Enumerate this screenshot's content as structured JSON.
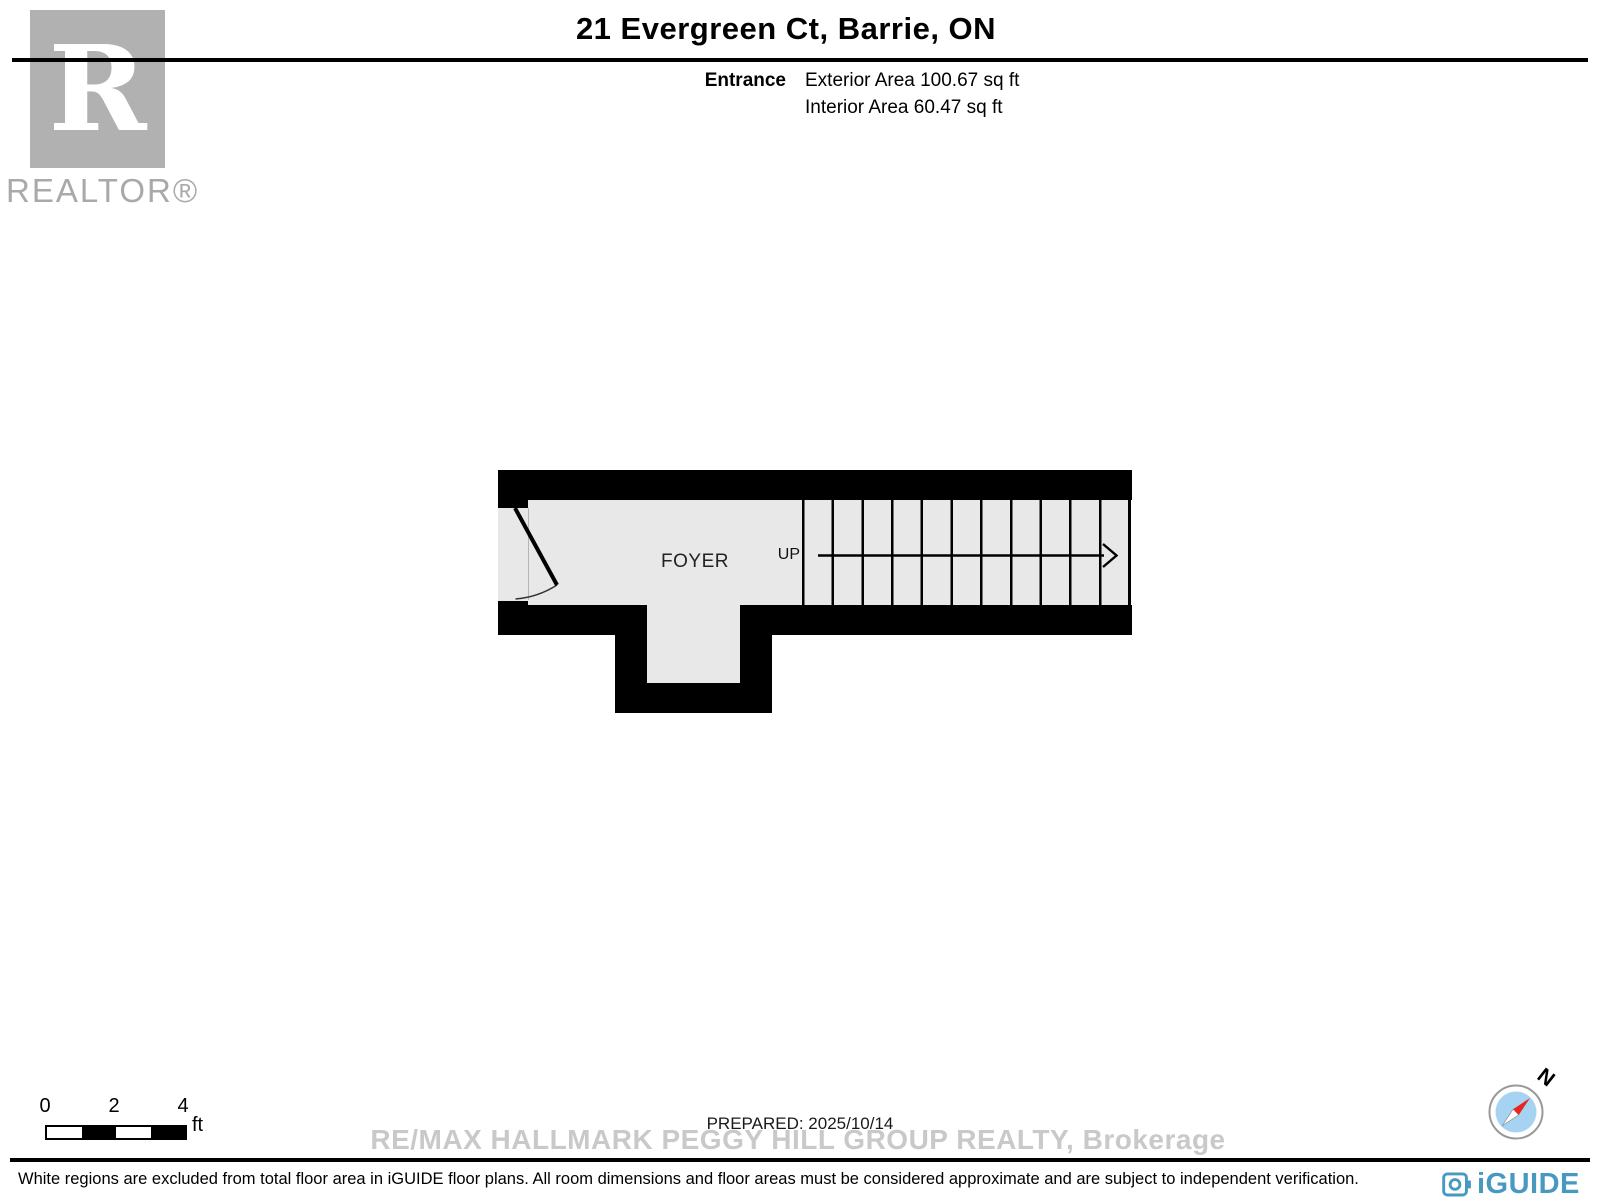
{
  "header": {
    "title": "21 Evergreen Ct, Barrie, ON",
    "floor_name": "Entrance",
    "exterior_area": "Exterior Area 100.67 sq ft",
    "interior_area": "Interior Area 60.47 sq ft"
  },
  "branding": {
    "realtor_logo_letter": "R",
    "realtor_wordmark": "REALTOR®",
    "iguide_wordmark": "iGUIDE",
    "iguide_color": "#4899c2",
    "realtor_gray": "#b1b1b1"
  },
  "floorplan": {
    "room_label": "FOYER",
    "stair_direction_label": "UP",
    "stair_tread_count": 11,
    "colors": {
      "floor": "#e8e8e8",
      "wall": "#000000"
    }
  },
  "scale_bar": {
    "labels": [
      "0",
      "2",
      "4"
    ],
    "unit": "ft"
  },
  "compass": {
    "north_label": "N",
    "colors": {
      "inner": "#a7d3f2",
      "needle_red": "#e8251f",
      "ring": "#999999"
    }
  },
  "footer": {
    "prepared_label": "PREPARED: 2025/10/14",
    "watermark": "RE/MAX HALLMARK PEGGY HILL GROUP REALTY, Brokerage",
    "disclaimer": "White regions are excluded from total floor area in iGUIDE floor plans. All room dimensions and floor areas must be considered approximate and are subject to independent verification."
  }
}
